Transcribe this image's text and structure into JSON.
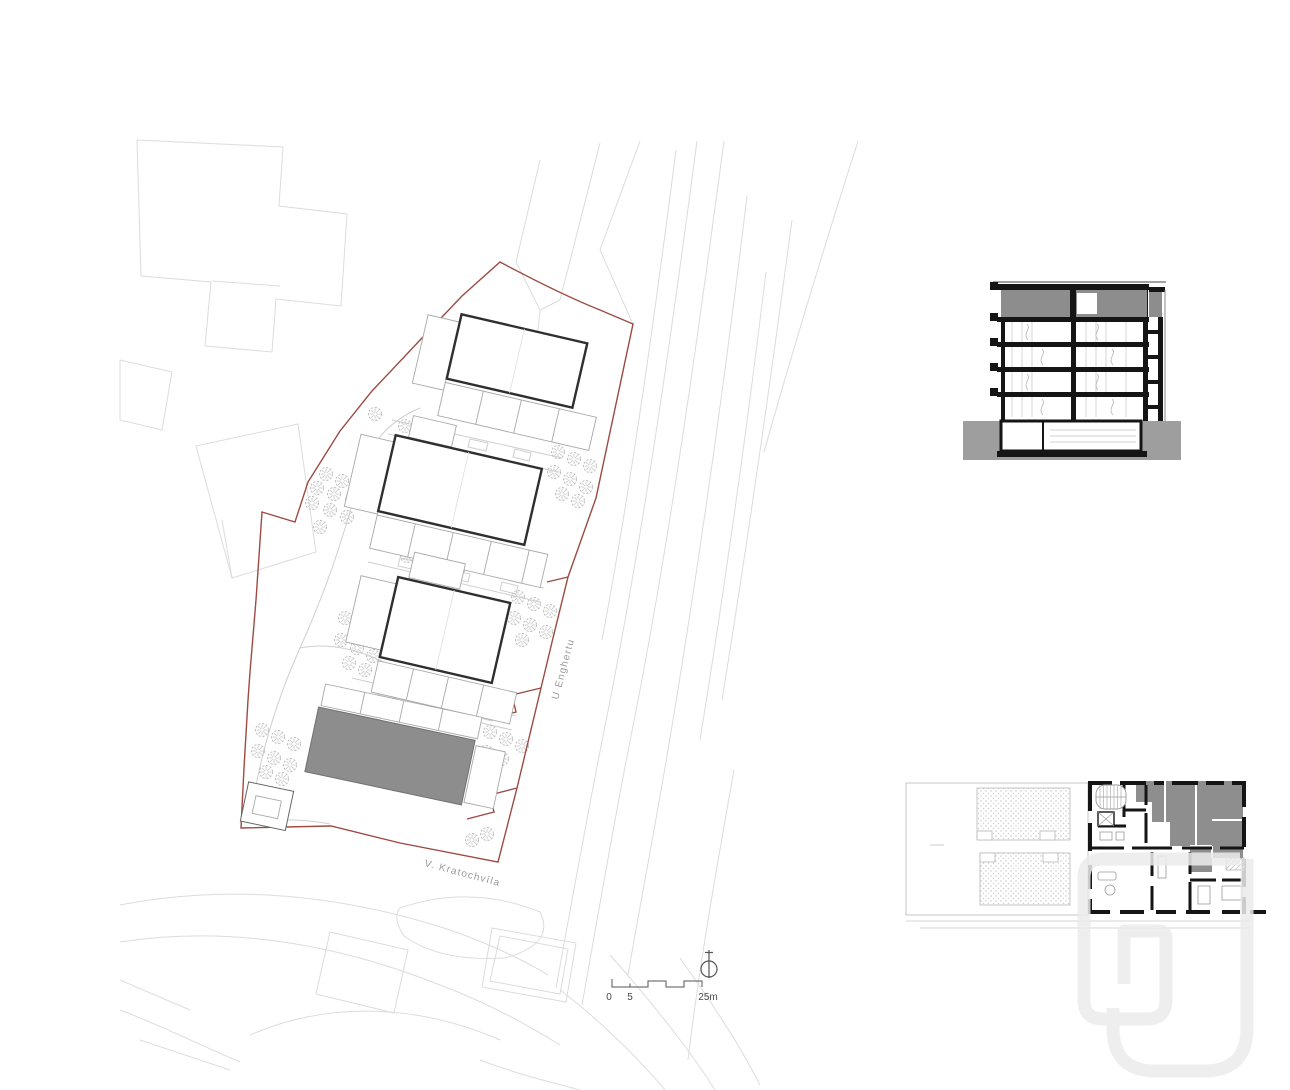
{
  "site_plan": {
    "street_label_right": "U Enghertu",
    "street_label_bottom": "V. Kratochvíla",
    "scale_bar": {
      "start_label": "0",
      "mid_label": "5",
      "end_label": "25m"
    },
    "colors": {
      "site_boundary_red": "#9c4a42",
      "building_outline": "#2f2f2f",
      "proposed_building_fill": "#8d8d8d",
      "context_line": "#dcdcdc",
      "path_line": "#cfcfcf",
      "tree_stroke": "#bdbdbd",
      "label_gray": "#9a9a9a"
    }
  },
  "section_drawing": {
    "colors": {
      "cut_black": "#151515",
      "attic_fill": "#8d8d8d",
      "ground_fill": "#9e9e9e"
    }
  },
  "floor_plan_drawing": {
    "colors": {
      "highlight_unit_fill": "#8e8e8e",
      "wall_black": "#151515",
      "terrace_stipple": "#c4c4c4"
    }
  },
  "watermark": {
    "color": "#ececec"
  }
}
